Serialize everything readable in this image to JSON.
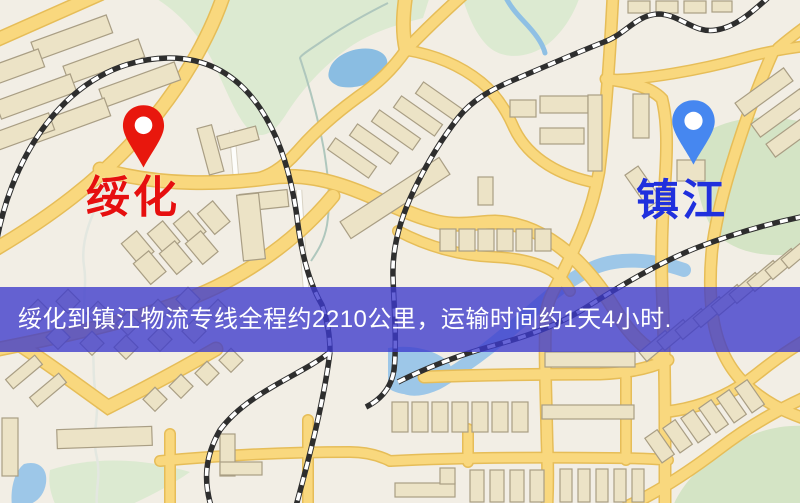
{
  "banner": {
    "text": "绥化到镇江物流专线全程约2210公里，运输时间约1天4小时.",
    "distance": "约2210公里",
    "duration": "约1天4小时",
    "bg_color": "#3c3acc",
    "text_color": "#ffffff"
  },
  "markers": {
    "origin": {
      "label": "绥化",
      "pin_color": "#e8170d",
      "label_color": "#e60f0f"
    },
    "destination": {
      "label": "镇江",
      "pin_color": "#4687f0",
      "label_color": "#2030dd"
    }
  },
  "map": {
    "type": "street-map",
    "colors": {
      "background": "#f2eee5",
      "park": "#dcead1",
      "water": "#9ac6e8",
      "road": "#f9d87e",
      "road_casing": "#e6bd58",
      "building": "#ece3c6",
      "building_outline": "#a99e84",
      "railway": "#2e2e2e"
    }
  }
}
